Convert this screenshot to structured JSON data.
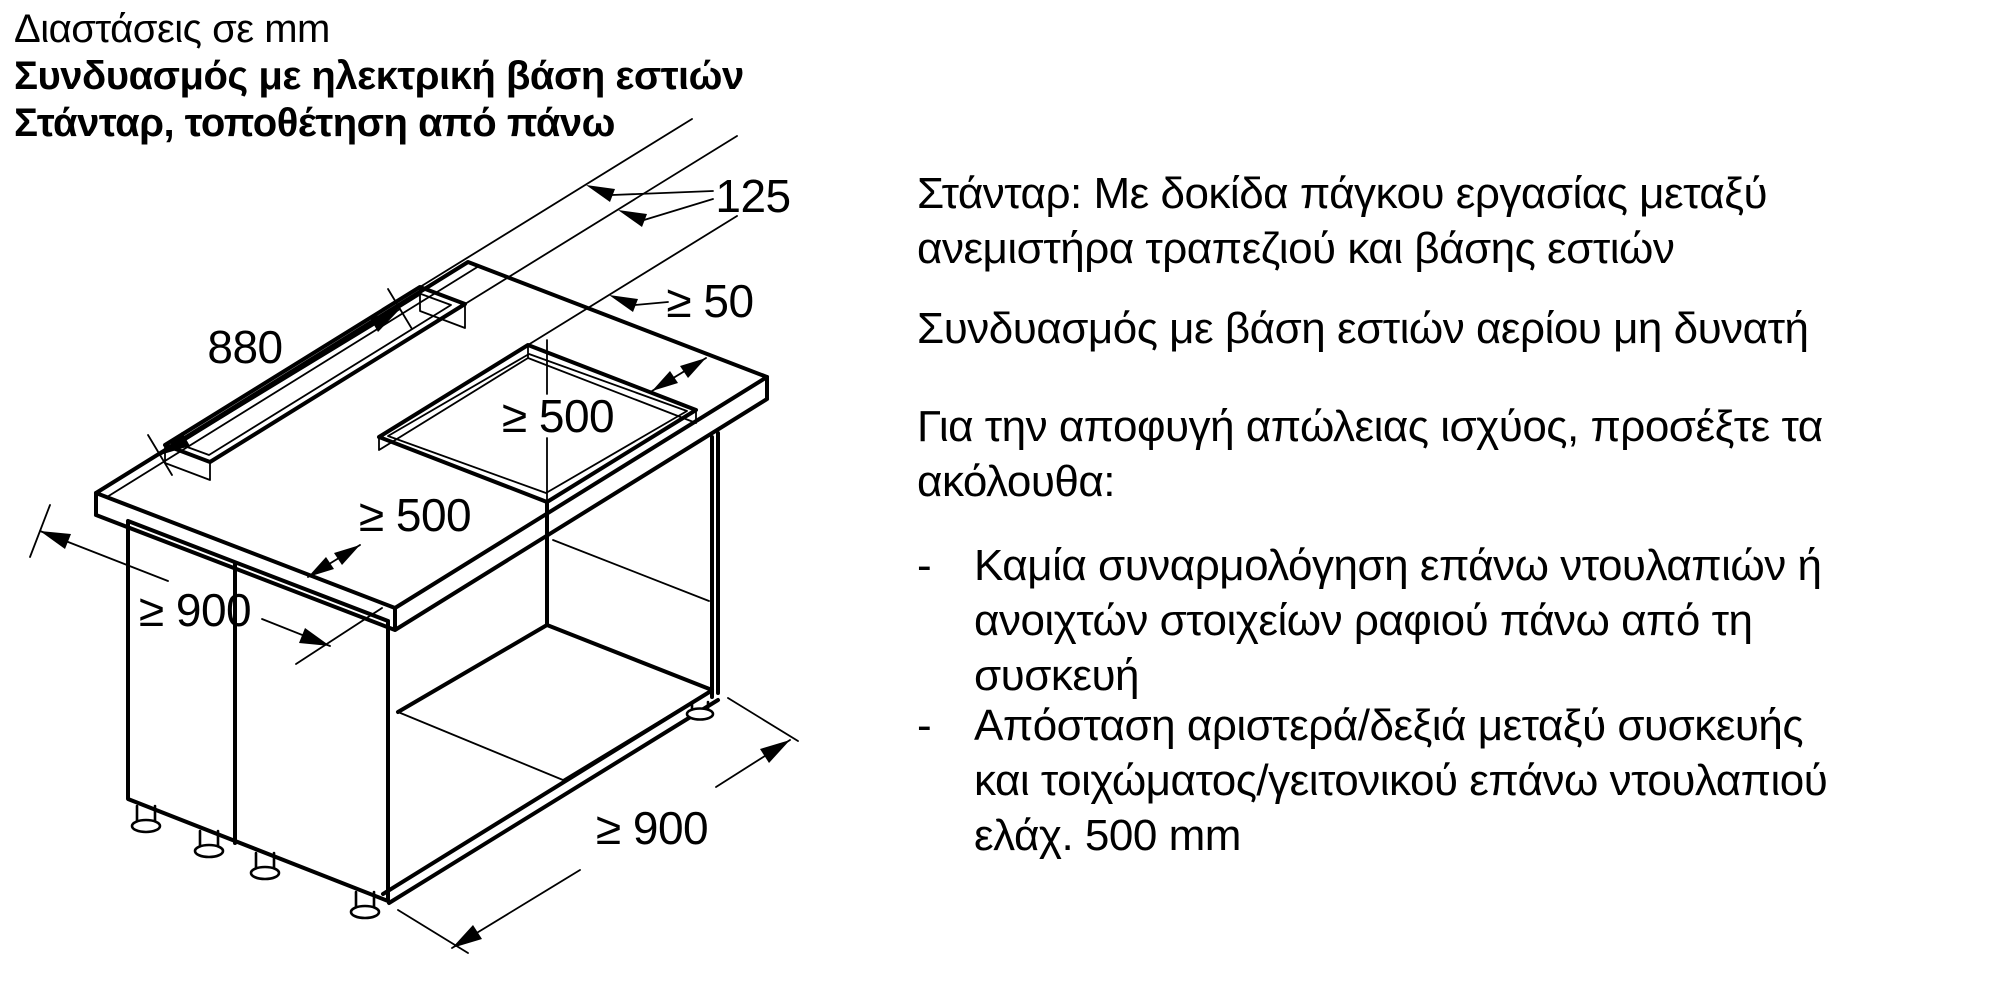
{
  "header": {
    "line1": "Διαστάσεις σε mm",
    "line2": "Συνδυασμός με ηλεκτρική βάση εστιών",
    "line3": "Στάνταρ, τοποθέτηση από πάνω"
  },
  "notes": {
    "bullet_marker": "-",
    "para1": {
      "line1": "Στάνταρ: Με δοκίδα πάγκου εργασίας μεταξύ",
      "line2": "ανεμιστήρα τραπεζιού και βάσης εστιών"
    },
    "para2": {
      "line1": "Συνδυασμός με βάση εστιών αερίου μη δυνατή"
    },
    "para3": {
      "line1": "Για την αποφυγή απώλειας ισχύος, προσέξτε τα",
      "line2": "ακόλουθα:"
    },
    "bullet1": {
      "line1": "Καμία συναρμολόγηση επάνω ντουλαπιών ή",
      "line2": "ανοιχτών στοιχείων ραφιού πάνω από τη",
      "line3": "συσκευή"
    },
    "bullet2": {
      "line1": "Απόσταση αριστερά/δεξιά μεταξύ συσκευής",
      "line2": "και τοιχώματος/γειτονικού επάνω ντουλαπιού",
      "line3": "ελάχ. 500 mm"
    }
  },
  "diagram": {
    "description": "Isometric drawing of base cabinet with worktop, vent slot and hob cutout",
    "line_color": "#000000",
    "dims": {
      "slot_width": "125",
      "slot_gap": "≥ 50",
      "slot_length": "880",
      "clearance_back": "≥ 500",
      "clearance_front": "≥ 500",
      "worktop_depth": "≥ 900",
      "cabinet_width": "≥ 900"
    }
  }
}
